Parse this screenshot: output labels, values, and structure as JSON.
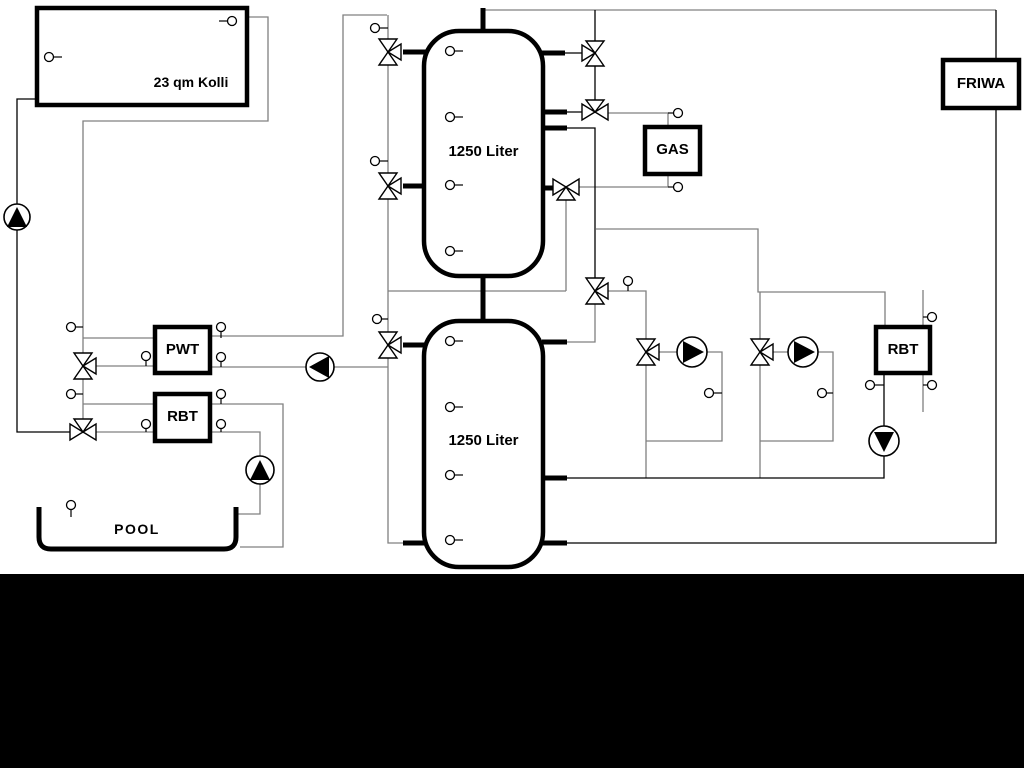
{
  "diagram": {
    "labels": {
      "collector": "23 qm Kolli",
      "tank_top": "1250 Liter",
      "tank_bottom": "1250 Liter",
      "gas": "GAS",
      "friwa": "FRIWA",
      "pwt": "PWT",
      "rbt_left": "RBT",
      "rbt_right": "RBT",
      "pool": "POOL"
    },
    "colors": {
      "line_black": "#000000",
      "line_gray": "#808080",
      "component_fill": "#ffffff",
      "background": "#ffffff",
      "bottom_band": "#000000"
    }
  }
}
